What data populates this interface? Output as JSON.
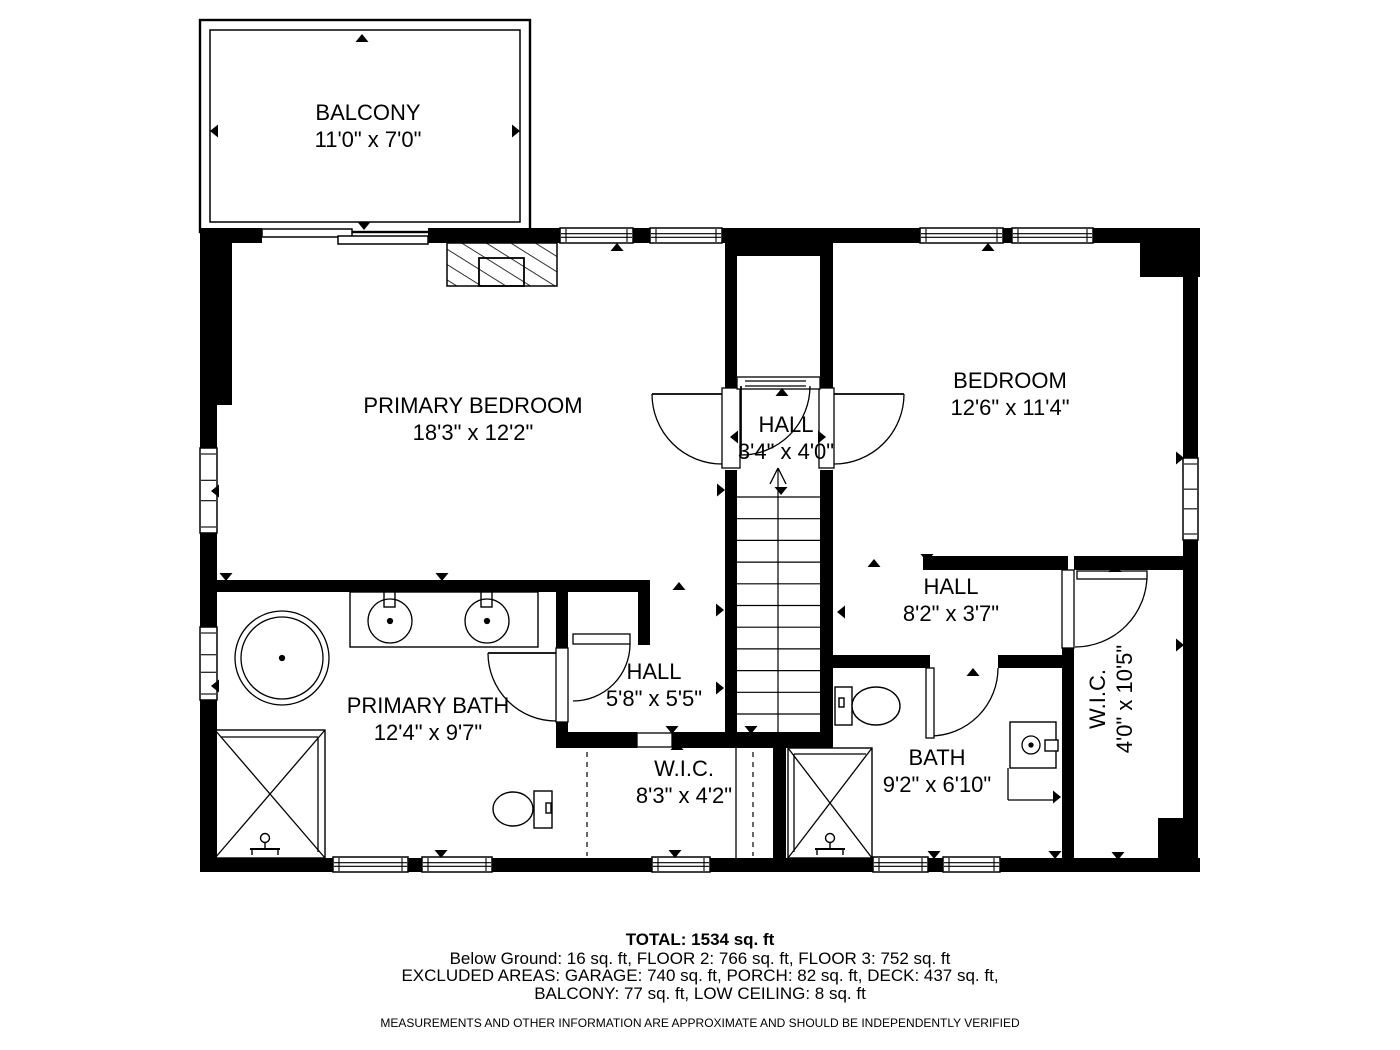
{
  "page": {
    "bg": "#ffffff",
    "ink": "#000000"
  },
  "rooms": [
    {
      "name": "BALCONY",
      "dims": "11'0\" x 7'0\"",
      "x": 368,
      "y": 127,
      "rot": 0
    },
    {
      "name": "PRIMARY BEDROOM",
      "dims": "18'3\" x 12'2\"",
      "x": 473,
      "y": 420,
      "rot": 0
    },
    {
      "name": "HALL",
      "dims": "3'4\" x 4'0\"",
      "x": 786,
      "y": 439,
      "rot": 0
    },
    {
      "name": "BEDROOM",
      "dims": "12'6\" x 11'4\"",
      "x": 1010,
      "y": 395,
      "rot": 0
    },
    {
      "name": "HALL",
      "dims": "8'2\" x 3'7\"",
      "x": 951,
      "y": 601,
      "rot": 0
    },
    {
      "name": "PRIMARY BATH",
      "dims": "12'4\" x 9'7\"",
      "x": 428,
      "y": 720,
      "rot": 0
    },
    {
      "name": "HALL",
      "dims": "5'8\" x 5'5\"",
      "x": 654,
      "y": 686,
      "rot": 0
    },
    {
      "name": "W.I.C.",
      "dims": "8'3\" x 4'2\"",
      "x": 684,
      "y": 783,
      "rot": 0
    },
    {
      "name": "BATH",
      "dims": "9'2\" x 6'10\"",
      "x": 937,
      "y": 772,
      "rot": 0
    },
    {
      "name": "W.I.C.",
      "dims": "4'0\" x 10'5\"",
      "x": 1112,
      "y": 699,
      "rot": -90
    }
  ],
  "footer": {
    "total": "TOTAL: 1534 sq. ft",
    "line2": "Below Ground: 16 sq. ft, FLOOR 2: 766 sq. ft, FLOOR 3: 752 sq. ft",
    "line3": "EXCLUDED AREAS: GARAGE: 740 sq. ft, PORCH: 82 sq. ft, DECK: 437 sq. ft,",
    "line4": "BALCONY: 77 sq. ft, LOW CEILING: 8 sq. ft",
    "disclaimer": "MEASUREMENTS AND OTHER INFORMATION ARE APPROXIMATE AND SHOULD BE INDEPENDENTLY VERIFIED"
  },
  "plan": {
    "balcony_rects": [
      [
        200,
        20,
        330,
        212,
        2.4
      ],
      [
        210,
        30,
        310,
        192,
        1.5
      ]
    ],
    "hatch": {
      "outer": [
        447,
        243,
        110,
        43
      ],
      "inner": [
        479,
        258,
        45,
        28
      ]
    },
    "walls": [
      [
        200,
        228,
        62,
        15
      ],
      [
        428,
        228,
        132,
        15
      ],
      [
        633,
        228,
        17,
        15
      ],
      [
        722,
        228,
        198,
        15
      ],
      [
        1003,
        228,
        9,
        15
      ],
      [
        1093,
        228,
        107,
        15
      ],
      [
        1140,
        243,
        60,
        34
      ],
      [
        1183,
        243,
        15,
        215
      ],
      [
        1183,
        540,
        15,
        332
      ],
      [
        1158,
        818,
        27,
        42
      ],
      [
        200,
        858,
        133,
        14
      ],
      [
        408,
        858,
        14,
        14
      ],
      [
        492,
        858,
        160,
        14
      ],
      [
        710,
        858,
        163,
        14
      ],
      [
        928,
        858,
        15,
        14
      ],
      [
        1000,
        858,
        200,
        14
      ],
      [
        200,
        243,
        17,
        205
      ],
      [
        200,
        533,
        17,
        94
      ],
      [
        200,
        700,
        17,
        158
      ],
      [
        217,
        243,
        15,
        162
      ],
      [
        725,
        243,
        12,
        147
      ],
      [
        725,
        470,
        12,
        278
      ],
      [
        820,
        243,
        13,
        147
      ],
      [
        820,
        470,
        13,
        278
      ],
      [
        737,
        243,
        83,
        13
      ],
      [
        737,
        378,
        9,
        9
      ],
      [
        806,
        378,
        9,
        9
      ],
      [
        217,
        580,
        433,
        12
      ],
      [
        638,
        580,
        12,
        65
      ],
      [
        556,
        580,
        12,
        70
      ],
      [
        556,
        722,
        12,
        22
      ],
      [
        556,
        732,
        81,
        16
      ],
      [
        672,
        732,
        161,
        16
      ],
      [
        773,
        748,
        13,
        110
      ],
      [
        923,
        556,
        145,
        14
      ],
      [
        1074,
        556,
        111,
        14
      ],
      [
        1062,
        647,
        12,
        211
      ],
      [
        833,
        655,
        97,
        13
      ],
      [
        998,
        655,
        64,
        13
      ]
    ],
    "windows_h": [
      [
        560,
        228,
        73,
        15
      ],
      [
        650,
        228,
        72,
        15
      ],
      [
        920,
        228,
        83,
        15
      ],
      [
        1012,
        228,
        81,
        15
      ],
      [
        333,
        857,
        75,
        15
      ],
      [
        422,
        857,
        70,
        15
      ],
      [
        652,
        857,
        58,
        15
      ],
      [
        873,
        857,
        55,
        15
      ],
      [
        943,
        857,
        57,
        15
      ]
    ],
    "windows_v": [
      [
        200,
        448,
        17,
        85
      ],
      [
        200,
        627,
        17,
        73
      ],
      [
        1183,
        458,
        15,
        82
      ]
    ],
    "slider_panels": [
      [
        262,
        229,
        90,
        8
      ],
      [
        338,
        236,
        90,
        8
      ]
    ],
    "casings": [
      [
        722,
        388,
        18,
        80
      ],
      [
        819,
        388,
        15,
        80
      ],
      [
        737,
        377,
        83,
        12
      ],
      [
        637,
        733,
        35,
        14
      ],
      [
        1062,
        570,
        12,
        78
      ],
      [
        556,
        648,
        12,
        74
      ]
    ],
    "stairs": {
      "x1": 737,
      "x2": 820,
      "ytop": 497,
      "step": 21.7,
      "count": 11,
      "cx": 778,
      "cy1": 468,
      "cy2": 732
    },
    "door_arcs": [
      "M652,394 A70,70 0 0 0 722,464",
      "M904,394 A70,70 0 0 1 834,464",
      "M810,386 A69,69 0 0 1 741,455",
      "M630,644 A57,57 0 0 1 573,701",
      "M488,653 A68,68 0 0 0 556,721",
      "M930,736 A68,68 0 0 0 998,668",
      "M1147,575 A72,72 0 0 1 1075,647"
    ],
    "door_leaf_lines": [
      [
        722,
        394,
        652,
        394
      ],
      [
        834,
        394,
        904,
        394
      ],
      [
        741,
        386,
        741,
        455
      ],
      [
        556,
        653,
        488,
        653
      ]
    ],
    "door_leaf_rects": [
      [
        926,
        668,
        8,
        70
      ],
      [
        1077,
        571,
        70,
        8
      ],
      [
        573,
        634,
        57,
        10
      ]
    ],
    "lines": [
      [
        745,
        381,
        806,
        381
      ],
      [
        745,
        386,
        806,
        386
      ],
      [
        736,
        748,
        736,
        858
      ],
      [
        215,
        730,
        325,
        858
      ],
      [
        325,
        730,
        215,
        858
      ],
      [
        221,
        737,
        318,
        737
      ],
      [
        318,
        737,
        318,
        852
      ],
      [
        788,
        748,
        872,
        858
      ],
      [
        872,
        748,
        788,
        858
      ],
      [
        794,
        754,
        866,
        754
      ],
      [
        794,
        754,
        794,
        852
      ],
      [
        1008,
        768,
        1008,
        800
      ],
      [
        1008,
        800,
        1056,
        800
      ],
      [
        778,
        468,
        770,
        484
      ],
      [
        778,
        468,
        786,
        484
      ]
    ],
    "dashed": [
      [
        587,
        752,
        587,
        856
      ],
      [
        753,
        752,
        753,
        856
      ]
    ],
    "outline_rects": [
      [
        215,
        730,
        110,
        128,
        "none"
      ],
      [
        788,
        748,
        84,
        110,
        "none"
      ],
      [
        350,
        592,
        188,
        55,
        "#fff"
      ],
      [
        1010,
        722,
        46,
        46,
        "#fff"
      ],
      [
        534,
        791,
        18,
        37,
        "#fff"
      ],
      [
        835,
        687,
        17,
        38,
        "#fff"
      ],
      [
        384,
        592,
        11,
        15,
        "#fff"
      ],
      [
        481,
        592,
        11,
        15,
        "#fff"
      ],
      [
        1045,
        740,
        13,
        11,
        "#fff"
      ],
      [
        546,
        803,
        5,
        10,
        "#fff"
      ],
      [
        839,
        698,
        5,
        9,
        "#fff"
      ]
    ],
    "circles": [
      [
        282,
        658,
        47,
        0
      ],
      [
        282,
        658,
        41,
        0
      ],
      [
        282,
        658,
        2.5,
        1
      ],
      [
        390,
        621,
        22,
        0
      ],
      [
        390,
        621,
        2.5,
        1
      ],
      [
        487,
        621,
        22,
        0
      ],
      [
        487,
        621,
        2.5,
        1
      ],
      [
        1031,
        745,
        9,
        0
      ],
      [
        1031,
        745,
        2,
        1
      ]
    ],
    "ellipses": [
      [
        513,
        809,
        20,
        17
      ],
      [
        876,
        706,
        24,
        19
      ]
    ],
    "shower_heads": [
      [
        265,
        846
      ],
      [
        830,
        846
      ]
    ],
    "arrows": [
      [
        362,
        38,
        "up"
      ],
      [
        617,
        247,
        "up"
      ],
      [
        988,
        247,
        "up"
      ],
      [
        874,
        563,
        "up"
      ],
      [
        973,
        672,
        "up"
      ],
      [
        1115,
        568,
        "up"
      ],
      [
        677,
        746,
        "up"
      ],
      [
        679,
        586,
        "up"
      ],
      [
        782,
        392,
        "up"
      ],
      [
        364,
        226,
        "down"
      ],
      [
        226,
        577,
        "down"
      ],
      [
        442,
        577,
        "down"
      ],
      [
        781,
        491,
        "down"
      ],
      [
        927,
        558,
        "down"
      ],
      [
        751,
        730,
        "down"
      ],
      [
        672,
        730,
        "down"
      ],
      [
        675,
        854,
        "down"
      ],
      [
        441,
        854,
        "down"
      ],
      [
        934,
        855,
        "down"
      ],
      [
        1055,
        855,
        "down"
      ],
      [
        1118,
        856,
        "down"
      ],
      [
        214,
        131,
        "left"
      ],
      [
        215,
        491,
        "left"
      ],
      [
        215,
        686,
        "left"
      ],
      [
        734,
        437,
        "left"
      ],
      [
        841,
        612,
        "left"
      ],
      [
        516,
        131,
        "right"
      ],
      [
        1180,
        458,
        "right"
      ],
      [
        1180,
        645,
        "right"
      ],
      [
        822,
        437,
        "right"
      ],
      [
        721,
        490,
        "right"
      ],
      [
        720,
        610,
        "right"
      ],
      [
        720,
        688,
        "right"
      ],
      [
        1057,
        797,
        "right"
      ]
    ]
  }
}
